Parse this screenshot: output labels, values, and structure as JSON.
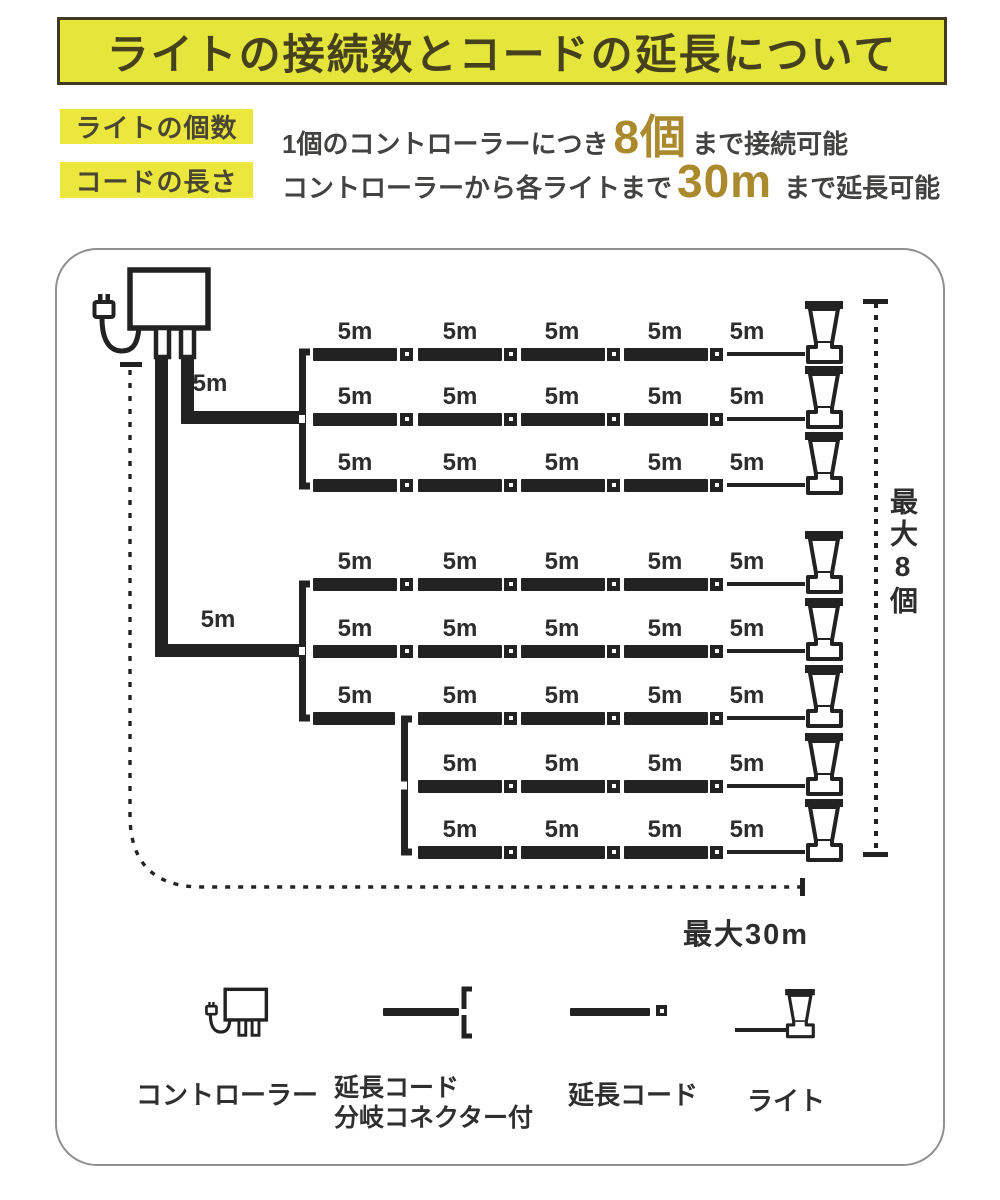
{
  "header": {
    "title": "ライトの接続数とコードの延長について"
  },
  "specs": [
    {
      "label": "ライトの個数",
      "pre": "1個のコントローラーにつき",
      "highlight": "8個",
      "post": "まで接続可能"
    },
    {
      "label": "コードの長さ",
      "pre": "コントローラーから各ライトまで",
      "highlight": "30m",
      "post": "まで延長可能"
    }
  ],
  "diagram": {
    "segment_label": "5m",
    "max_lights_label": "最大8個",
    "max_length_label": "最大30m",
    "rows": [
      {
        "y": 354,
        "bars": [
          1,
          2,
          3,
          4
        ],
        "squares": [
          1,
          2,
          3,
          4
        ],
        "labels": [
          1,
          2,
          3,
          4,
          5
        ]
      },
      {
        "y": 419,
        "bars": [
          1,
          2,
          3,
          4
        ],
        "squares": [
          1,
          2,
          3,
          4
        ],
        "labels": [
          1,
          2,
          3,
          4,
          5
        ]
      },
      {
        "y": 485,
        "bars": [
          1,
          2,
          3,
          4
        ],
        "squares": [
          1,
          2,
          3,
          4
        ],
        "labels": [
          1,
          2,
          3,
          4,
          5
        ]
      },
      {
        "y": 584,
        "bars": [
          1,
          2,
          3,
          4
        ],
        "squares": [
          1,
          2,
          3,
          4
        ],
        "labels": [
          1,
          2,
          3,
          4,
          5
        ]
      },
      {
        "y": 651,
        "bars": [
          1,
          2,
          3,
          4
        ],
        "squares": [
          1,
          2,
          3,
          4
        ],
        "labels": [
          1,
          2,
          3,
          4,
          5
        ]
      },
      {
        "y": 718,
        "bars": [
          1,
          2,
          3,
          4
        ],
        "squares": [
          2,
          3,
          4
        ],
        "labels": [
          1,
          2,
          3,
          4,
          5
        ]
      },
      {
        "y": 786,
        "bars": [
          2,
          3,
          4
        ],
        "squares": [
          2,
          3,
          4
        ],
        "labels": [
          2,
          3,
          4,
          5
        ]
      },
      {
        "y": 852,
        "bars": [
          2,
          3,
          4
        ],
        "squares": [
          2,
          3,
          4
        ],
        "labels": [
          2,
          3,
          4,
          5
        ]
      }
    ],
    "brackets": [
      {
        "x": 296,
        "y1": 344,
        "y2": 494
      },
      {
        "x": 296,
        "y1": 576,
        "y2": 726
      },
      {
        "x": 398,
        "y1": 711,
        "y2": 860
      }
    ],
    "feeds": [
      {
        "vx": 181,
        "vy1": 357,
        "vy2": 424,
        "hy": 411,
        "hx1": 181,
        "hx2": 301,
        "lx": 178,
        "ly": 370
      },
      {
        "vx": 155,
        "vy1": 357,
        "vy2": 657,
        "hy": 644,
        "hx1": 155,
        "hx2": 301,
        "lx": 186,
        "ly": 606
      }
    ]
  },
  "legend": [
    {
      "label": "コントローラー"
    },
    {
      "label": "延長コード",
      "label2": "分岐コネクター付"
    },
    {
      "label": "延長コード"
    },
    {
      "label": "ライト"
    }
  ],
  "colors": {
    "banner_bg": "#e5e63c",
    "banner_text": "#46401d",
    "label_bg": "#ebe73d",
    "accent_gold": "#ab8a2e",
    "line_color": "#222222"
  }
}
